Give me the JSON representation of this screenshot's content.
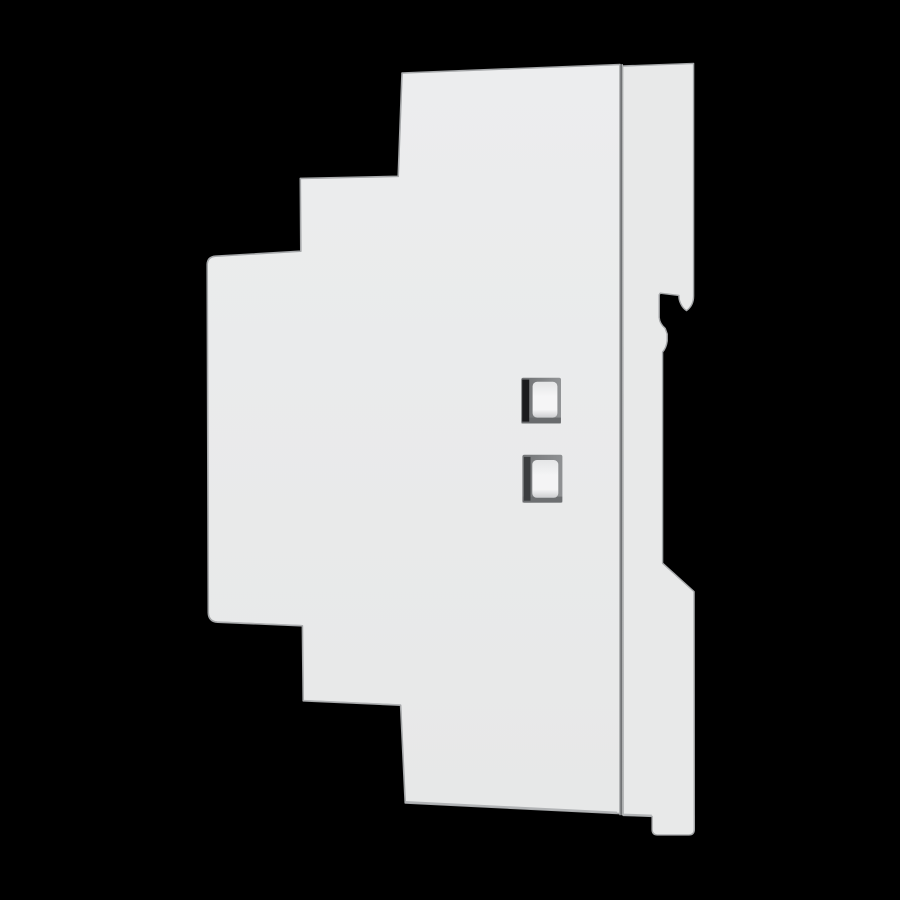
{
  "canvas": {
    "width": 900,
    "height": 900,
    "background": "#000000",
    "subject": "Side view product photo of a white plastic DIN-rail mount module enclosure on a black background"
  },
  "module": {
    "body_fill_top": "#ecedee",
    "body_fill_bottom": "#e7e8e8",
    "plate_fill": "#e8e9e9",
    "outline": "#a2a4a6",
    "inner_bevel": "#d0d2d3",
    "bottom_bevel": "#b2b4b6",
    "divider_left": "#bbbdbe",
    "divider_core": "#5e6062",
    "divider_right": "#c9cbcc",
    "claw_shadow": "#b5b7b9",
    "flare_ridge": "#f4f5f5",
    "flare_dark": "#95989a",
    "flare_light": "#d9dadb",
    "tab_light": "#f1f2f2",
    "tab_mid": "#e6e7e8",
    "tab_dark": "#d1d2d3",
    "tab_crease": "#bfc1c2"
  },
  "buttons": {
    "upper": {
      "frame_start": "#6e7072",
      "frame_end": "#929496",
      "frame_bottom": "#696b6d",
      "slot": "#1b1b1d",
      "face_top": "#e4e5e6",
      "face_mid": "#f5f5f6",
      "face_bottom": "#cdced0"
    },
    "lower": {
      "frame_start": "#747678",
      "frame_end": "#8f9193",
      "frame_bottom": "#6d6f71",
      "slot": "#3b3d3f",
      "face_top": "#e4e5e6",
      "face_mid": "#f4f4f5",
      "face_bottom": "#cdced0"
    }
  }
}
